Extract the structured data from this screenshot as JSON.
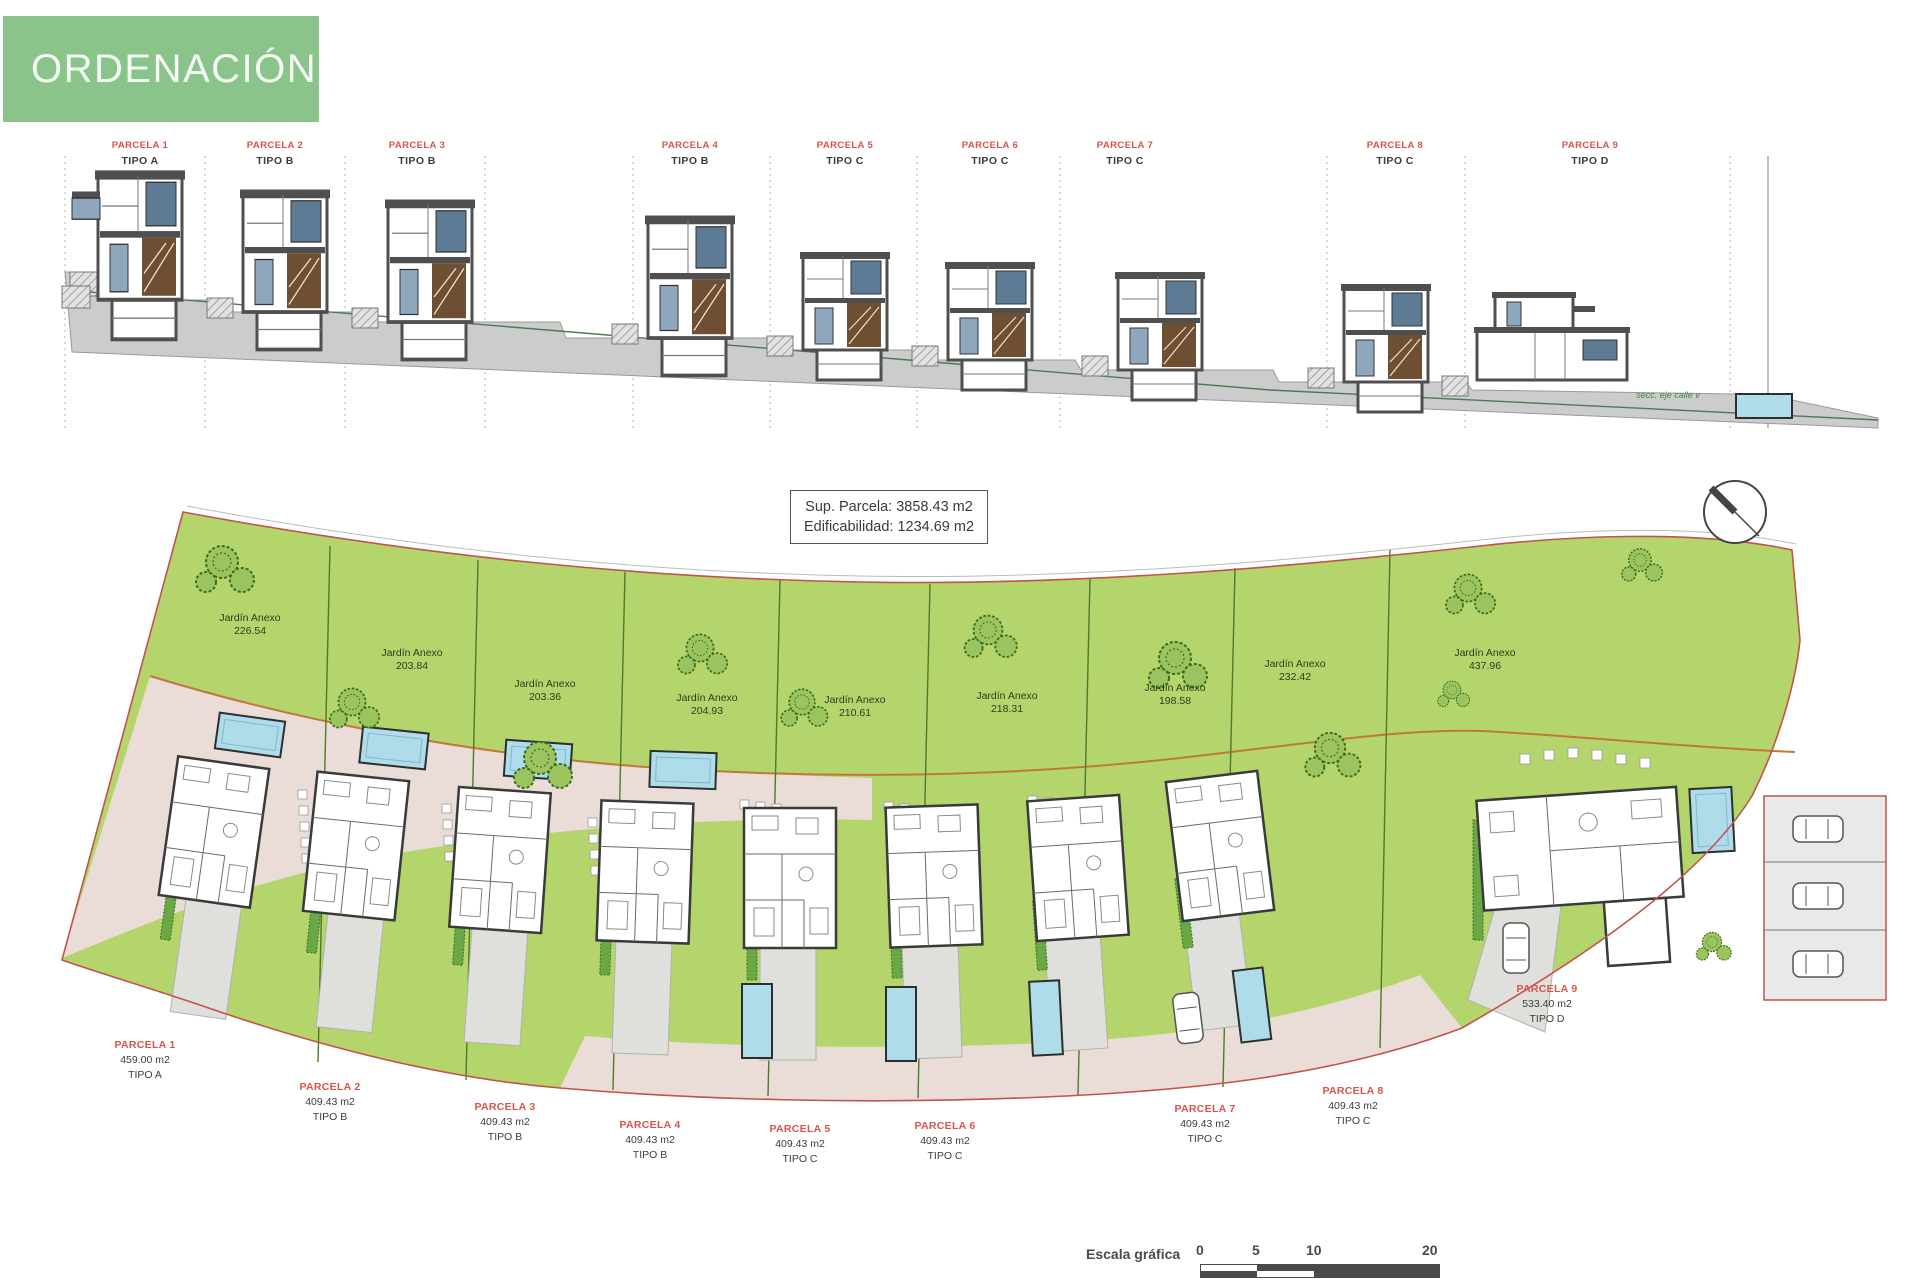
{
  "header": {
    "title": "ORDENACIÓN"
  },
  "elevation": {
    "note": "secc. eje calle v",
    "parcels": [
      {
        "name": "PARCELA 1",
        "tipo": "TIPO A"
      },
      {
        "name": "PARCELA 2",
        "tipo": "TIPO B"
      },
      {
        "name": "PARCELA 3",
        "tipo": "TIPO B"
      },
      {
        "name": "PARCELA 4",
        "tipo": "TIPO B"
      },
      {
        "name": "PARCELA 5",
        "tipo": "TIPO C"
      },
      {
        "name": "PARCELA 6",
        "tipo": "TIPO C"
      },
      {
        "name": "PARCELA 7",
        "tipo": "TIPO C"
      },
      {
        "name": "PARCELA 8",
        "tipo": "TIPO C"
      },
      {
        "name": "PARCELA 9",
        "tipo": "TIPO D"
      }
    ]
  },
  "plan": {
    "info": {
      "line1": "Sup. Parcela:  3858.43 m2",
      "line2": "Edificabilidad: 1234.69 m2"
    },
    "gardens": [
      {
        "label": "Jardín Anexo",
        "area": "226.54"
      },
      {
        "label": "Jardín Anexo",
        "area": "203.84"
      },
      {
        "label": "Jardín Anexo",
        "area": "203.36"
      },
      {
        "label": "Jardín Anexo",
        "area": "204.93"
      },
      {
        "label": "Jardín Anexo",
        "area": "210.61"
      },
      {
        "label": "Jardín Anexo",
        "area": "218.31"
      },
      {
        "label": "Jardín Anexo",
        "area": "198.58"
      },
      {
        "label": "Jardín Anexo",
        "area": "232.42"
      },
      {
        "label": "Jardín Anexo",
        "area": "437.96"
      }
    ],
    "parcels": [
      {
        "name": "PARCELA 1",
        "area": "459.00 m2",
        "tipo": "TIPO A"
      },
      {
        "name": "PARCELA 2",
        "area": "409.43 m2",
        "tipo": "TIPO B"
      },
      {
        "name": "PARCELA 3",
        "area": "409.43 m2",
        "tipo": "TIPO B"
      },
      {
        "name": "PARCELA 4",
        "area": "409.43 m2",
        "tipo": "TIPO B"
      },
      {
        "name": "PARCELA 5",
        "area": "409.43 m2",
        "tipo": "TIPO C"
      },
      {
        "name": "PARCELA 6",
        "area": "409.43 m2",
        "tipo": "TIPO C"
      },
      {
        "name": "PARCELA 7",
        "area": "409.43 m2",
        "tipo": "TIPO C"
      },
      {
        "name": "PARCELA 8",
        "area": "409.43 m2",
        "tipo": "TIPO C"
      },
      {
        "name": "PARCELA 9",
        "area": "533.40 m2",
        "tipo": "TIPO D"
      }
    ]
  },
  "scalebar": {
    "label": "Escala gráfica",
    "ticks": [
      "0",
      "5",
      "10",
      "20"
    ]
  },
  "colors": {
    "header_bg": "#8ac48a",
    "header_fg": "#f4fbf4",
    "parcela_red": "#d9534a",
    "text_dark": "#3c3c3c",
    "garden_text": "#2f3d1c",
    "site_green": "#b4d46c",
    "tree_green": "#3a6b22",
    "road_pink": "#eadcd6",
    "drive_gray": "#dfdfdb",
    "pool_blue": "#aedcea",
    "boundary_red": "#c2534b",
    "orange_line": "#c0773a",
    "parcel_line": "#4f7a28",
    "wall_gray": "#4f4f4f",
    "win_blue": "#5d7b94",
    "stair_brown": "#6f4f32",
    "ground_gray": "#cccccc",
    "slope_green": "#4e7a52"
  }
}
